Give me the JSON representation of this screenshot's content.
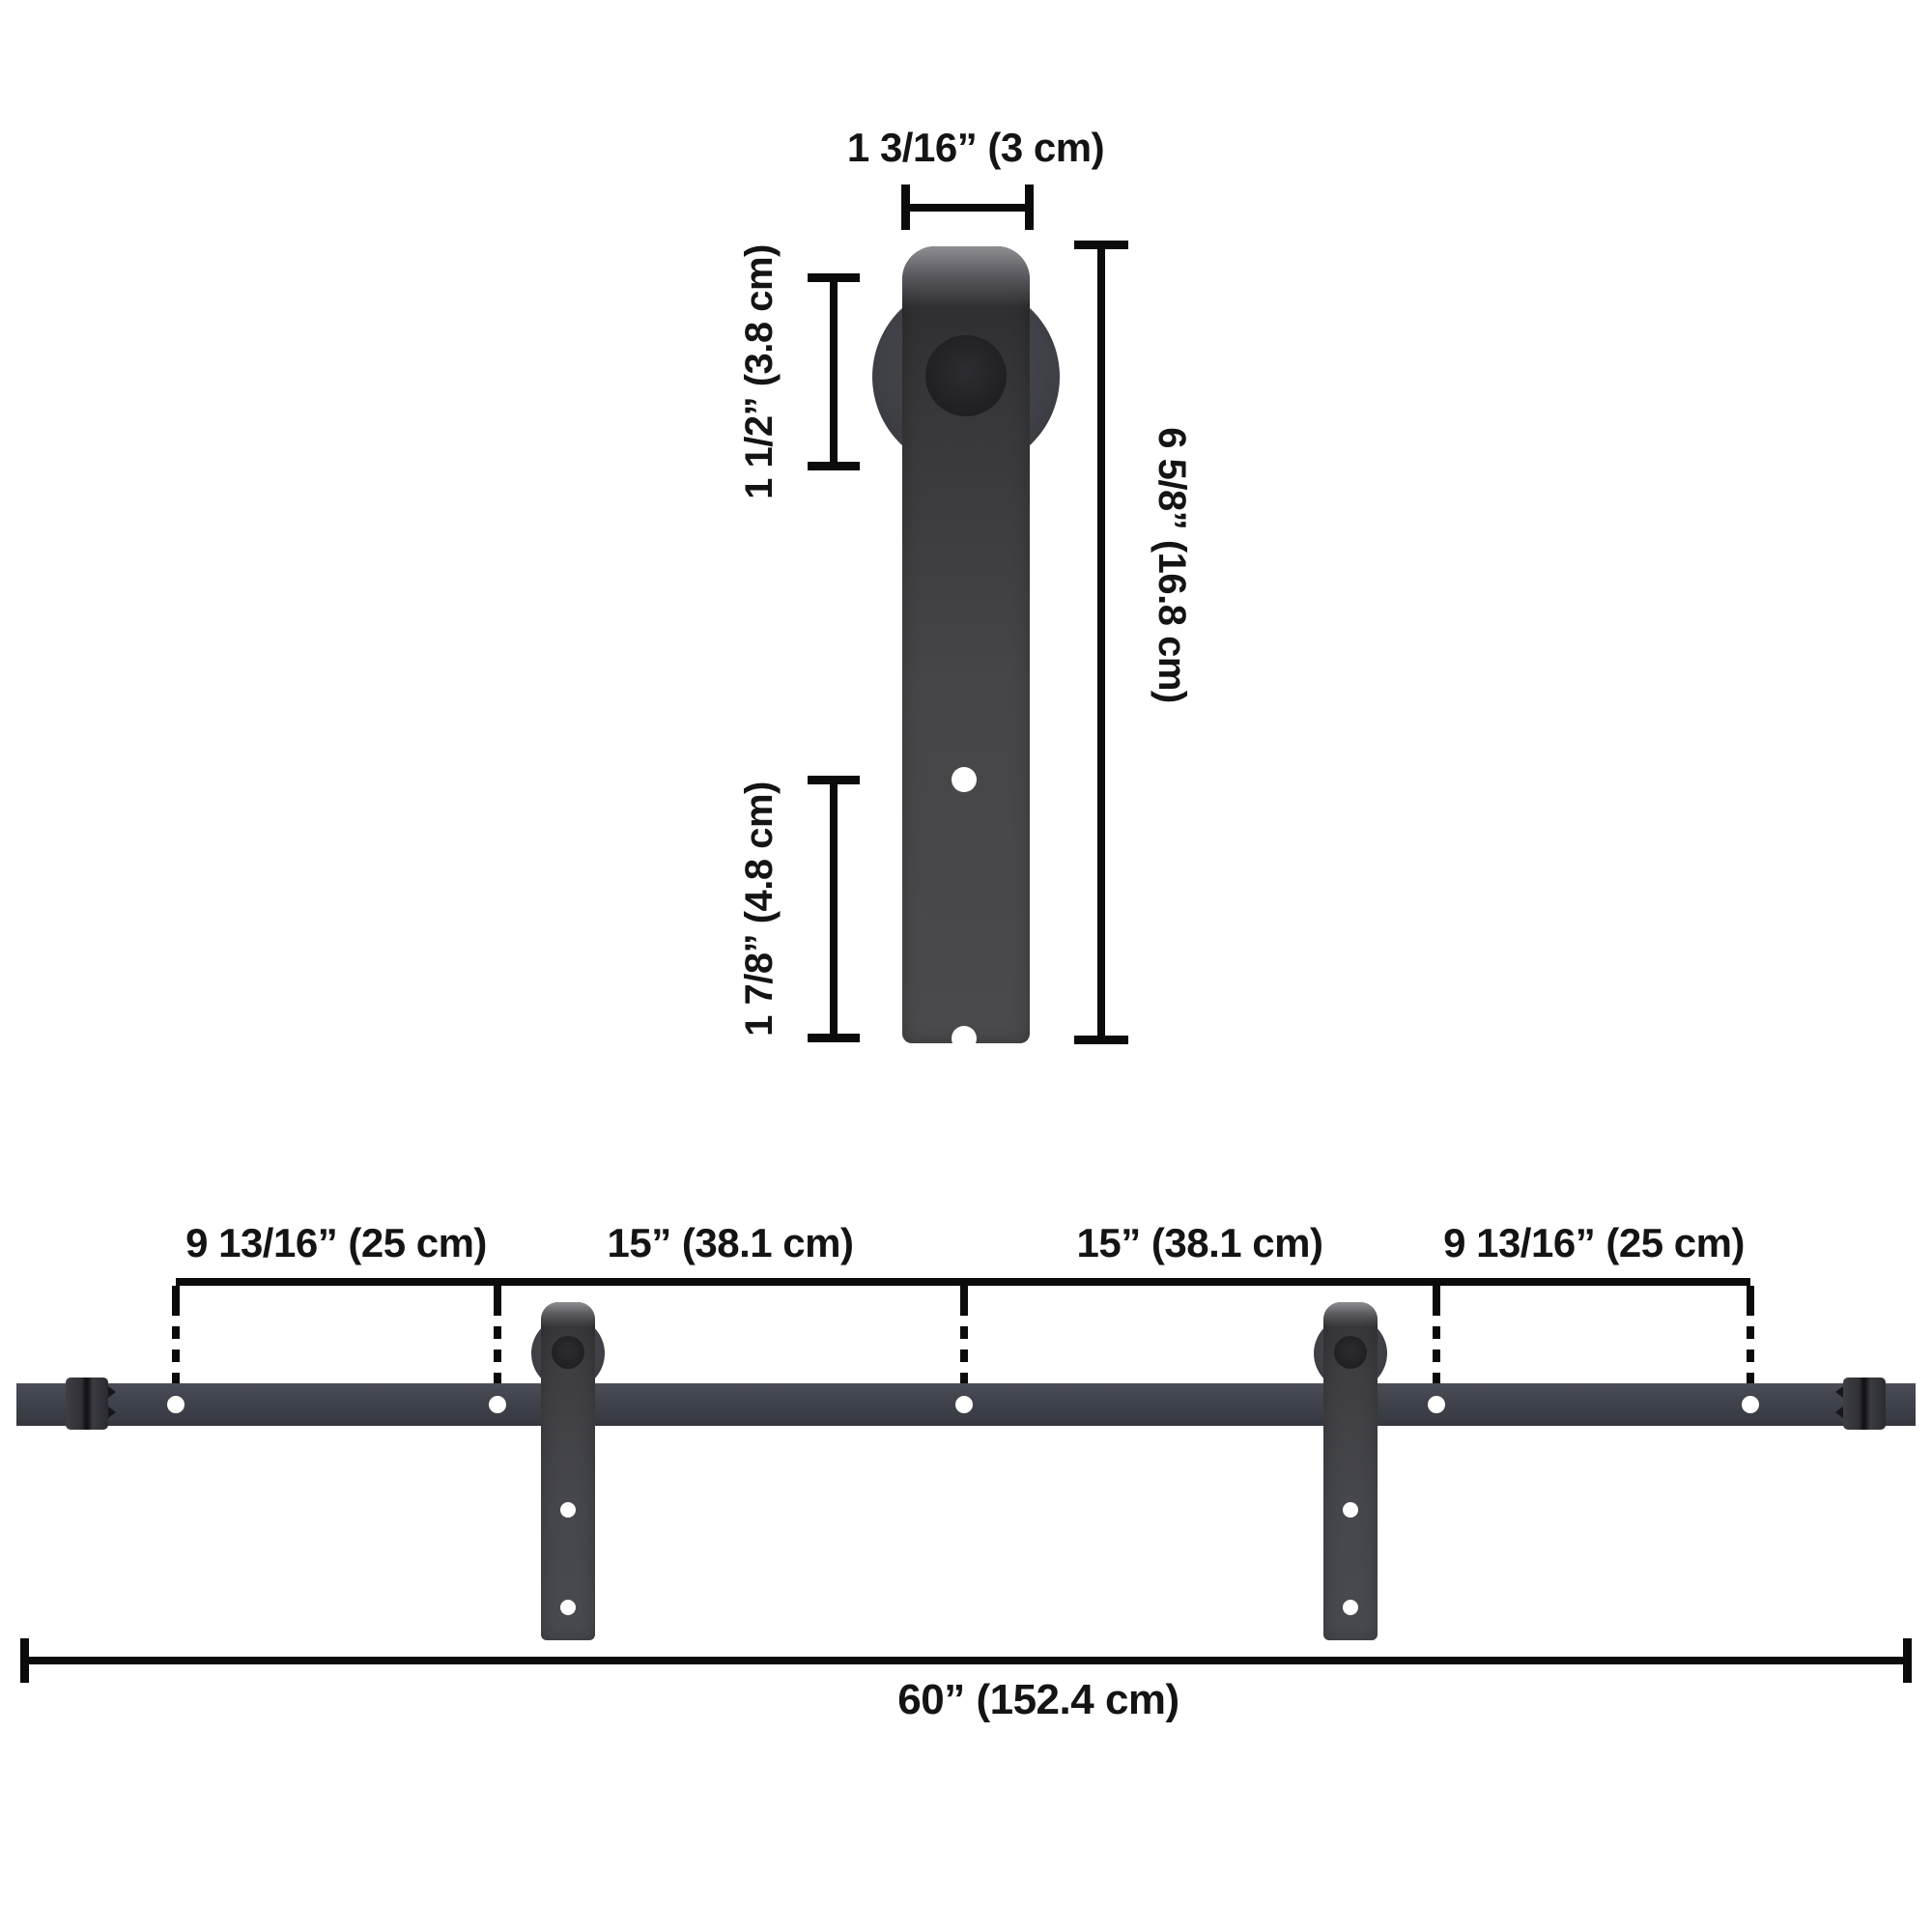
{
  "hanger_detail": {
    "top_width_label": "1 3/16” (3 cm)",
    "roller_diameter_label": "1 1/2” (3.8 cm)",
    "hole_spacing_label": "1 7/8” (4.8 cm)",
    "total_height_label": "6 5/8” (16.8 cm)"
  },
  "rail_assembly": {
    "sections": [
      "9 13/16” (25 cm)",
      "15” (38.1 cm)",
      "15” (38.1 cm)",
      "9 13/16” (25 cm)"
    ],
    "total_length_label": "60” (152.4 cm)"
  },
  "colors": {
    "bg": "#ffffff",
    "line": "#0b0b0b",
    "hole": "#ffffff",
    "rail-mid": "#3f424b",
    "strap-mid": "#46464a",
    "hub-dark": "#202024"
  }
}
